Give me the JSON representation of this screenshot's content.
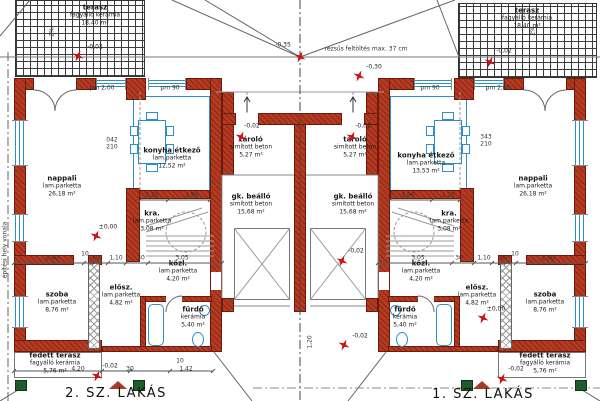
{
  "titles": {
    "left_unit": "2. SZ. LAKÁS",
    "right_unit": "1. SZ. LAKÁS"
  },
  "colors": {
    "wall": "#b43a22",
    "fixture": "#2e8fc6",
    "marker": "#cc1111",
    "column_green": "#1f5c2d"
  },
  "rooms": [
    {
      "name": "terasz",
      "finish": "fagyálló kerámia",
      "area": "18,40 m²",
      "x": 95,
      "y": 15
    },
    {
      "name": "terasz",
      "finish": "fagyálló kerámia",
      "area": "18,40 m²",
      "x": 527,
      "y": 18
    },
    {
      "name": "nappali",
      "finish": "lam.parketta",
      "area": "26,18 m²",
      "x": 62,
      "y": 186
    },
    {
      "name": "konyha étkező",
      "finish": "lam.parketta",
      "area": "12,52 m²",
      "x": 172,
      "y": 158
    },
    {
      "name": "kra.",
      "finish": "lam.parketta",
      "area": "3,08 m²",
      "x": 152,
      "y": 221
    },
    {
      "name": "közl.",
      "finish": "lam.parketta",
      "area": "4,20 m²",
      "x": 178,
      "y": 271
    },
    {
      "name": "fürdő",
      "finish": "kerámia",
      "area": "5,40 m²",
      "x": 193,
      "y": 317
    },
    {
      "name": "elősz.",
      "finish": "lam.parketta",
      "area": "4,82 m²",
      "x": 121,
      "y": 295
    },
    {
      "name": "szoba",
      "finish": "lam.parketta",
      "area": "8,76 m²",
      "x": 57,
      "y": 302
    },
    {
      "name": "fedett terasz",
      "finish": "fagyálló kerámia",
      "area": "5,76 m²",
      "x": 55,
      "y": 363
    },
    {
      "name": "tároló",
      "finish": "simított beton",
      "area": "5,27 m²",
      "x": 251,
      "y": 147
    },
    {
      "name": "gk. beálló",
      "finish": "simított beton",
      "area": "15,68 m²",
      "x": 251,
      "y": 204
    },
    {
      "name": "tároló",
      "finish": "simított beton",
      "area": "5,27 m²",
      "x": 355,
      "y": 147
    },
    {
      "name": "gk. beálló",
      "finish": "simított beton",
      "area": "15,68 m²",
      "x": 353,
      "y": 204
    },
    {
      "name": "konyha étkező",
      "finish": "lam.parketta",
      "area": "13,53 m²",
      "x": 426,
      "y": 163
    },
    {
      "name": "nappali",
      "finish": "lam.parketta",
      "area": "26,18 m²",
      "x": 533,
      "y": 186
    },
    {
      "name": "kra.",
      "finish": "lam.parketta",
      "area": "3,08 m²",
      "x": 449,
      "y": 221
    },
    {
      "name": "közl.",
      "finish": "lam.parketta",
      "area": "4,20 m²",
      "x": 421,
      "y": 271
    },
    {
      "name": "fürdő",
      "finish": "kerámia",
      "area": "5,40 m²",
      "x": 405,
      "y": 317
    },
    {
      "name": "elősz.",
      "finish": "lam.parketta",
      "area": "4,82 m²",
      "x": 477,
      "y": 295
    },
    {
      "name": "szoba",
      "finish": "lam.parketta",
      "area": "8,76 m²",
      "x": 545,
      "y": 302
    },
    {
      "name": "fedett terasz",
      "finish": "fagyálló kerámia",
      "area": "5,76 m²",
      "x": 545,
      "y": 363
    }
  ],
  "levels": [
    {
      "text": "-0,02",
      "tx": 95,
      "ty": 47,
      "sx": 78,
      "sy": 56
    },
    {
      "text": "-0,35",
      "tx": 283,
      "ty": 45,
      "sx": 300,
      "sy": 57
    },
    {
      "text": "-0,30",
      "tx": 374,
      "ty": 67,
      "sx": 359,
      "sy": 76
    },
    {
      "text": "-0,02",
      "tx": 504,
      "ty": 51,
      "sx": 490,
      "sy": 62
    },
    {
      "text": "-0,02",
      "tx": 252,
      "ty": 126,
      "sx": 241,
      "sy": 137
    },
    {
      "text": "-0,02",
      "tx": 363,
      "ty": 126,
      "sx": 352,
      "sy": 137
    },
    {
      "text": "±0,00",
      "tx": 108,
      "ty": 227,
      "sx": 96,
      "sy": 236
    },
    {
      "text": "±0,00",
      "tx": 496,
      "ty": 309,
      "sx": 483,
      "sy": 318
    },
    {
      "text": "-0,02",
      "tx": 356,
      "ty": 251,
      "sx": 342,
      "sy": 261
    },
    {
      "text": "-0,02",
      "tx": 360,
      "ty": 336,
      "sx": 344,
      "sy": 345
    },
    {
      "text": "-0,02",
      "tx": 110,
      "ty": 366,
      "sx": 97,
      "sy": 376
    },
    {
      "text": "-0,02",
      "tx": 516,
      "ty": 369,
      "sx": 502,
      "sy": 379
    }
  ],
  "small_texts": [
    {
      "text": "rézsűs feltöltés max. 37 cm",
      "x": 366,
      "y": 49
    },
    {
      "text": "pm 2,00",
      "x": 102,
      "y": 88
    },
    {
      "text": "pm 90",
      "x": 170,
      "y": 88
    },
    {
      "text": "pm 90",
      "x": 430,
      "y": 88
    },
    {
      "text": "pm 2,00",
      "x": 498,
      "y": 88
    },
    {
      "text": "2,40",
      "x": 52,
      "y": 258
    },
    {
      "text": "10",
      "x": 85,
      "y": 254
    },
    {
      "text": "60",
      "x": 96,
      "y": 258
    },
    {
      "text": "1,10",
      "x": 116,
      "y": 258
    },
    {
      "text": "30",
      "x": 141,
      "y": 258
    },
    {
      "text": "3,05",
      "x": 182,
      "y": 258
    },
    {
      "text": "3,05",
      "x": 418,
      "y": 258
    },
    {
      "text": "30",
      "x": 459,
      "y": 258
    },
    {
      "text": "1,10",
      "x": 484,
      "y": 258
    },
    {
      "text": "60",
      "x": 504,
      "y": 258
    },
    {
      "text": "10",
      "x": 515,
      "y": 254
    },
    {
      "text": "2,40",
      "x": 548,
      "y": 258
    },
    {
      "text": "1,10",
      "x": 152,
      "y": 195
    },
    {
      "text": "1,90",
      "x": 192,
      "y": 195
    },
    {
      "text": "1,90",
      "x": 408,
      "y": 195
    },
    {
      "text": "1,10",
      "x": 448,
      "y": 195
    },
    {
      "text": "4,20",
      "x": 78,
      "y": 369
    },
    {
      "text": "30",
      "x": 130,
      "y": 369
    },
    {
      "text": "10",
      "x": 180,
      "y": 361
    },
    {
      "text": "1,42",
      "x": 186,
      "y": 369
    },
    {
      "text": "042",
      "x": 112,
      "y": 140
    },
    {
      "text": "210",
      "x": 112,
      "y": 147
    },
    {
      "text": "343",
      "x": 486,
      "y": 137
    },
    {
      "text": "210",
      "x": 486,
      "y": 144
    },
    {
      "text": "1,20",
      "x": 310,
      "y": 342,
      "v": true
    },
    {
      "text": "2%",
      "x": 52,
      "y": 32,
      "v": true
    },
    {
      "text": "2%",
      "x": 533,
      "y": 31,
      "v": true
    },
    {
      "text": "építési hely vonala",
      "x": 5,
      "y": 250,
      "v": true
    }
  ]
}
